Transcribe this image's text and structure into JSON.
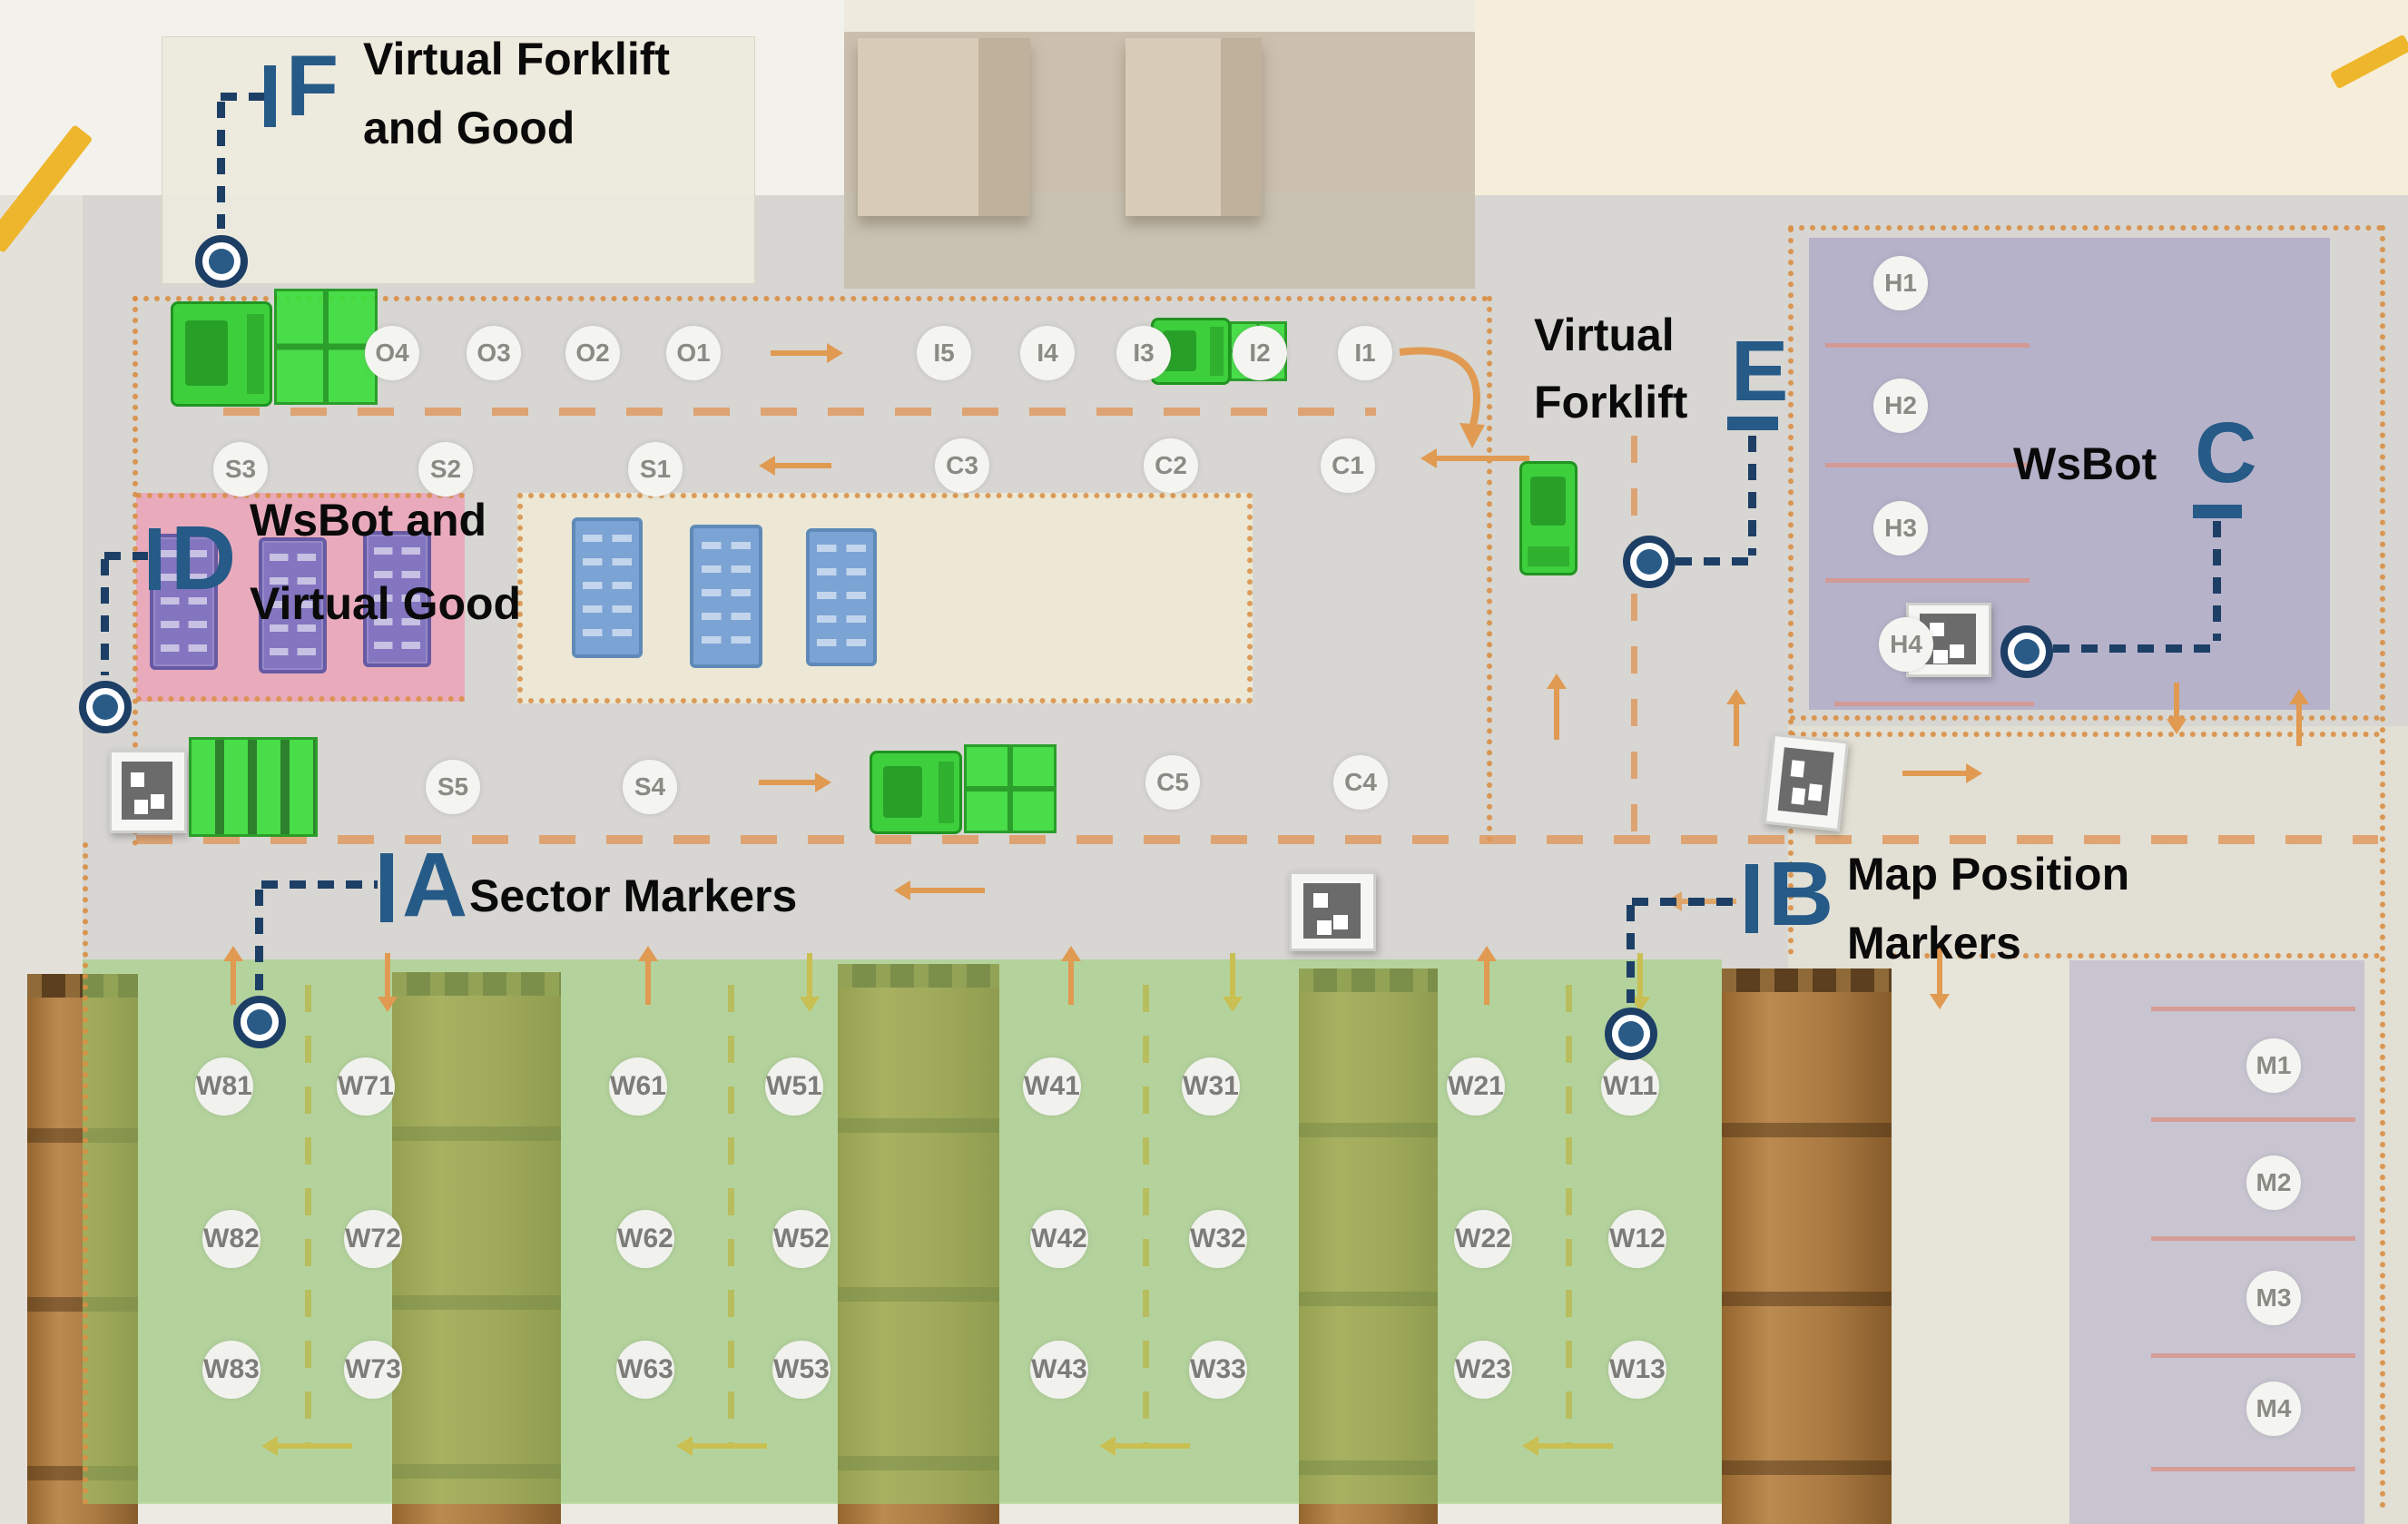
{
  "annotations": {
    "a": {
      "letter": "A",
      "label": "Sector Markers"
    },
    "b": {
      "letter": "B",
      "line1": "Map Position",
      "line2": "Markers"
    },
    "c": {
      "letter": "C",
      "label": "WsBot"
    },
    "d": {
      "letter": "D",
      "line1": "WsBot and",
      "line2": "Virtual Good"
    },
    "e": {
      "letter": "E",
      "line1": "Virtual",
      "line2": "Forklift"
    },
    "f": {
      "letter": "F",
      "line1": "Virtual Forklift",
      "line2": "and Good"
    }
  },
  "markers": {
    "o": [
      "O4",
      "O3",
      "O2",
      "O1"
    ],
    "i": [
      "I5",
      "I4",
      "I3",
      "I2",
      "I1"
    ],
    "s1": [
      "S3",
      "S2",
      "S1"
    ],
    "c1": [
      "C3",
      "C2",
      "C1"
    ],
    "s2": [
      "S5",
      "S4"
    ],
    "c2": [
      "C5",
      "C4"
    ],
    "h": [
      "H1",
      "H2",
      "H3",
      "H4"
    ],
    "m": [
      "M1",
      "M2",
      "M3",
      "M4"
    ],
    "w1": [
      "W81",
      "W71",
      "W61",
      "W51",
      "W41",
      "W31",
      "W21",
      "W11"
    ],
    "w2": [
      "W82",
      "W72",
      "W62",
      "W52",
      "W42",
      "W32",
      "W22",
      "W12"
    ],
    "w3": [
      "W83",
      "W73",
      "W63",
      "W53",
      "W43",
      "W33",
      "W23",
      "W13"
    ]
  },
  "colors": {
    "annotation_letter_blue": "#265a87",
    "annotation_dash_navy": "#1d3f66",
    "zone_border_orange": "#d98e44",
    "zone_pink": "#ef9cb4",
    "zone_green": "#97d26f",
    "zone_lavender": "#b2adc8",
    "virtual_object_green": "#3ede3e",
    "pallet_purple": "#8375c0",
    "pallet_blue": "#7ba3d4"
  }
}
